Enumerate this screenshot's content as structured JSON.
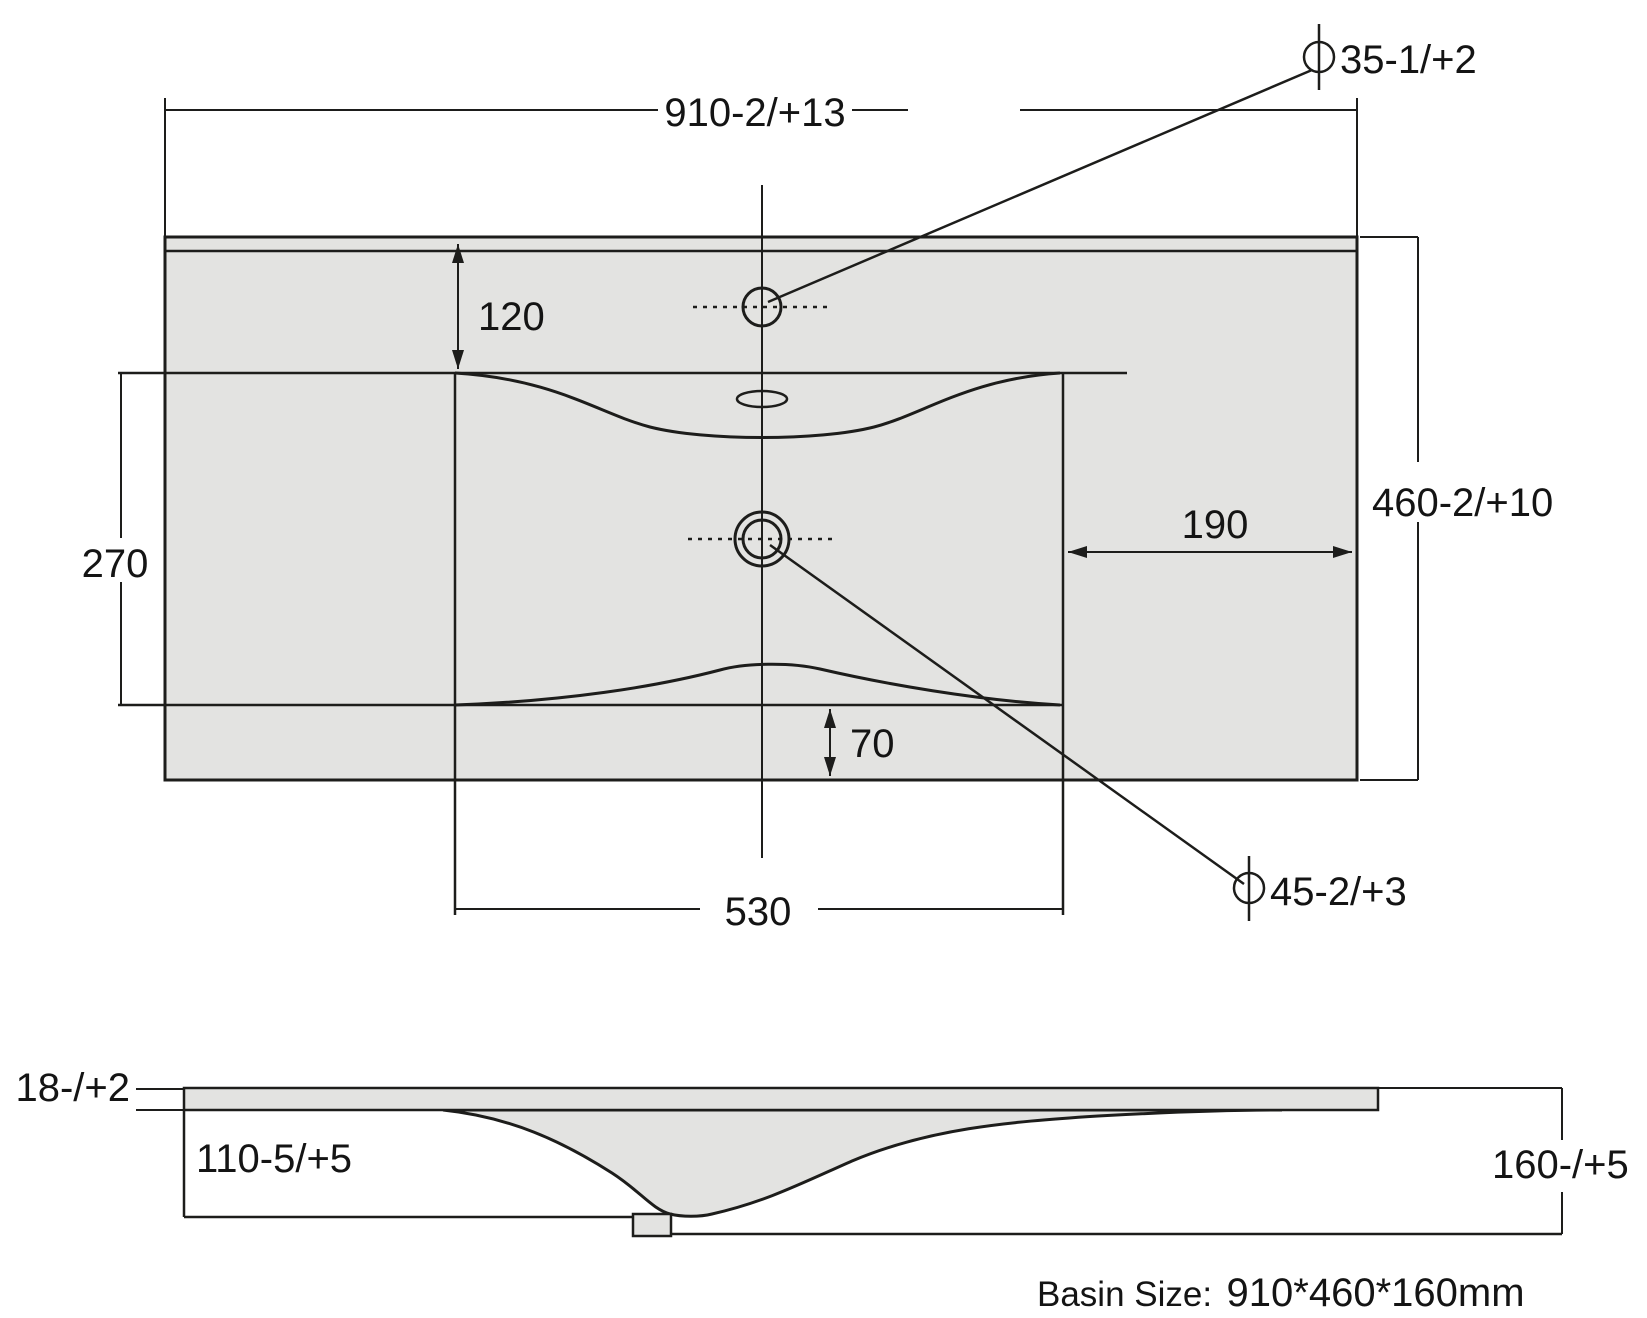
{
  "colors": {
    "background": "#ffffff",
    "line": "#1d1d1b",
    "fill": "#e3e3e1"
  },
  "top_view": {
    "overall_width_dim": "910-2/+13",
    "overall_depth_dim": "460-2/+10",
    "faucet_hole": {
      "symbol": "⌀",
      "value": "35-1/+2"
    },
    "drain_hole": {
      "symbol": "⌀",
      "value": "45-2/+3"
    },
    "faucet_center_offset_dim": "120",
    "bowl_front_back_dim": "270",
    "drain_to_right_edge_dim": "190",
    "bowl_to_front_edge_dim": "70",
    "bowl_width_dim": "530"
  },
  "section_view": {
    "deck_thickness_dim": "18-/+2",
    "edge_height_dim": "110-5/+5",
    "overall_height_dim": "160-/+5"
  },
  "caption": {
    "label": "Basin Size:",
    "value": "910*460*160mm"
  }
}
